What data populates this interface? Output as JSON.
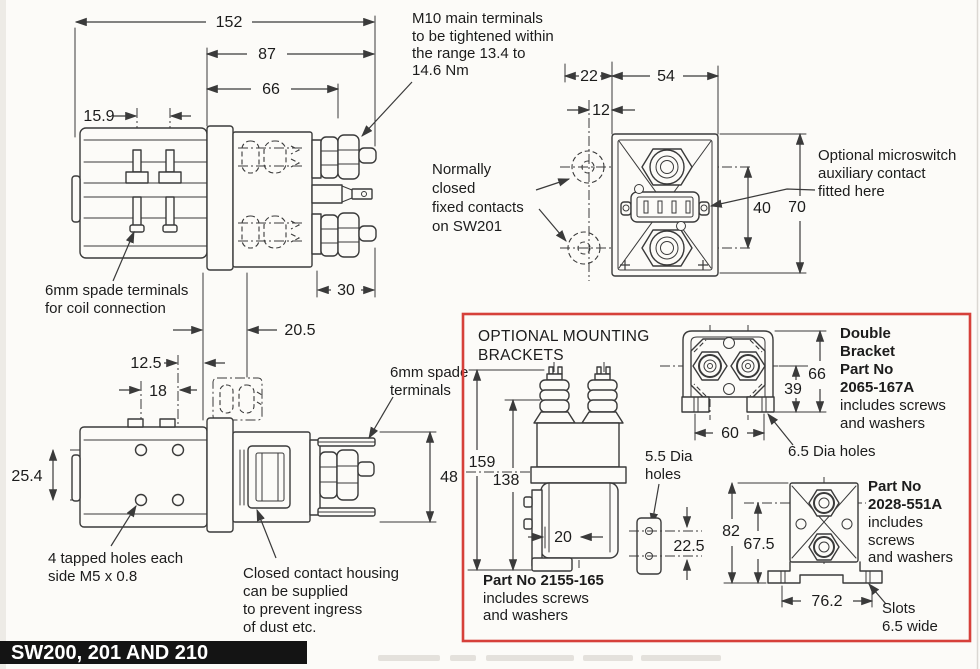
{
  "colors": {
    "line": "#3a3a3a",
    "accent_red": "#d6403a",
    "banner_bg": "#141414",
    "banner_text": "#ffffff",
    "paper": "#fcfbf8"
  },
  "banner": {
    "title": "SW200, 201 AND 210"
  },
  "notes": {
    "m10": [
      "M10 main terminals",
      "to be tightened within",
      "the range 13.4 to",
      "14.6 Nm"
    ],
    "nc": [
      "Normally",
      "closed",
      "fixed contacts",
      "on SW201"
    ],
    "micro": [
      "Optional microswitch",
      "auxiliary contact",
      "fitted here"
    ],
    "spade_coil": [
      "6mm spade terminals",
      "for coil connection"
    ],
    "spade": [
      "6mm spade",
      "terminals"
    ],
    "tapped": [
      "4 tapped holes each",
      "side M5 x 0.8"
    ],
    "housing": [
      "Closed contact housing",
      "can be supplied",
      "to prevent ingress",
      "of dust etc."
    ]
  },
  "dims": {
    "side": {
      "w152": "152",
      "w87": "87",
      "w66": "66",
      "w15_9": "15.9",
      "w30": "30",
      "w20_5": "20.5"
    },
    "front": {
      "w22": "22",
      "w12": "12",
      "w54": "54",
      "h40": "40",
      "h70": "70"
    },
    "bottom": {
      "w12_5": "12.5",
      "w18": "18",
      "h25_4": "25.4",
      "h48": "48"
    }
  },
  "brackets": {
    "title": [
      "OPTIONAL MOUNTING",
      "BRACKETS"
    ],
    "single": {
      "h159": "159",
      "h138": "138",
      "w20": "20",
      "part": [
        "Part No 2155-165",
        "includes screws",
        "and washers"
      ]
    },
    "plate": {
      "label": [
        "5.5 Dia",
        "holes"
      ],
      "h22_5": "22.5"
    },
    "double": {
      "h39": "39",
      "h66": "66",
      "w60": "60",
      "holes": "6.5 Dia holes",
      "part": [
        "Double",
        "Bracket",
        "Part No",
        "2065-167A",
        "includes screws",
        "and washers"
      ]
    },
    "single2": {
      "h82": "82",
      "h67_5": "67.5",
      "w76_2": "76.2",
      "part": [
        "Part No",
        "2028-551A",
        "includes",
        "screws",
        "and washers"
      ],
      "slots": [
        "Slots",
        "6.5 wide"
      ]
    }
  }
}
